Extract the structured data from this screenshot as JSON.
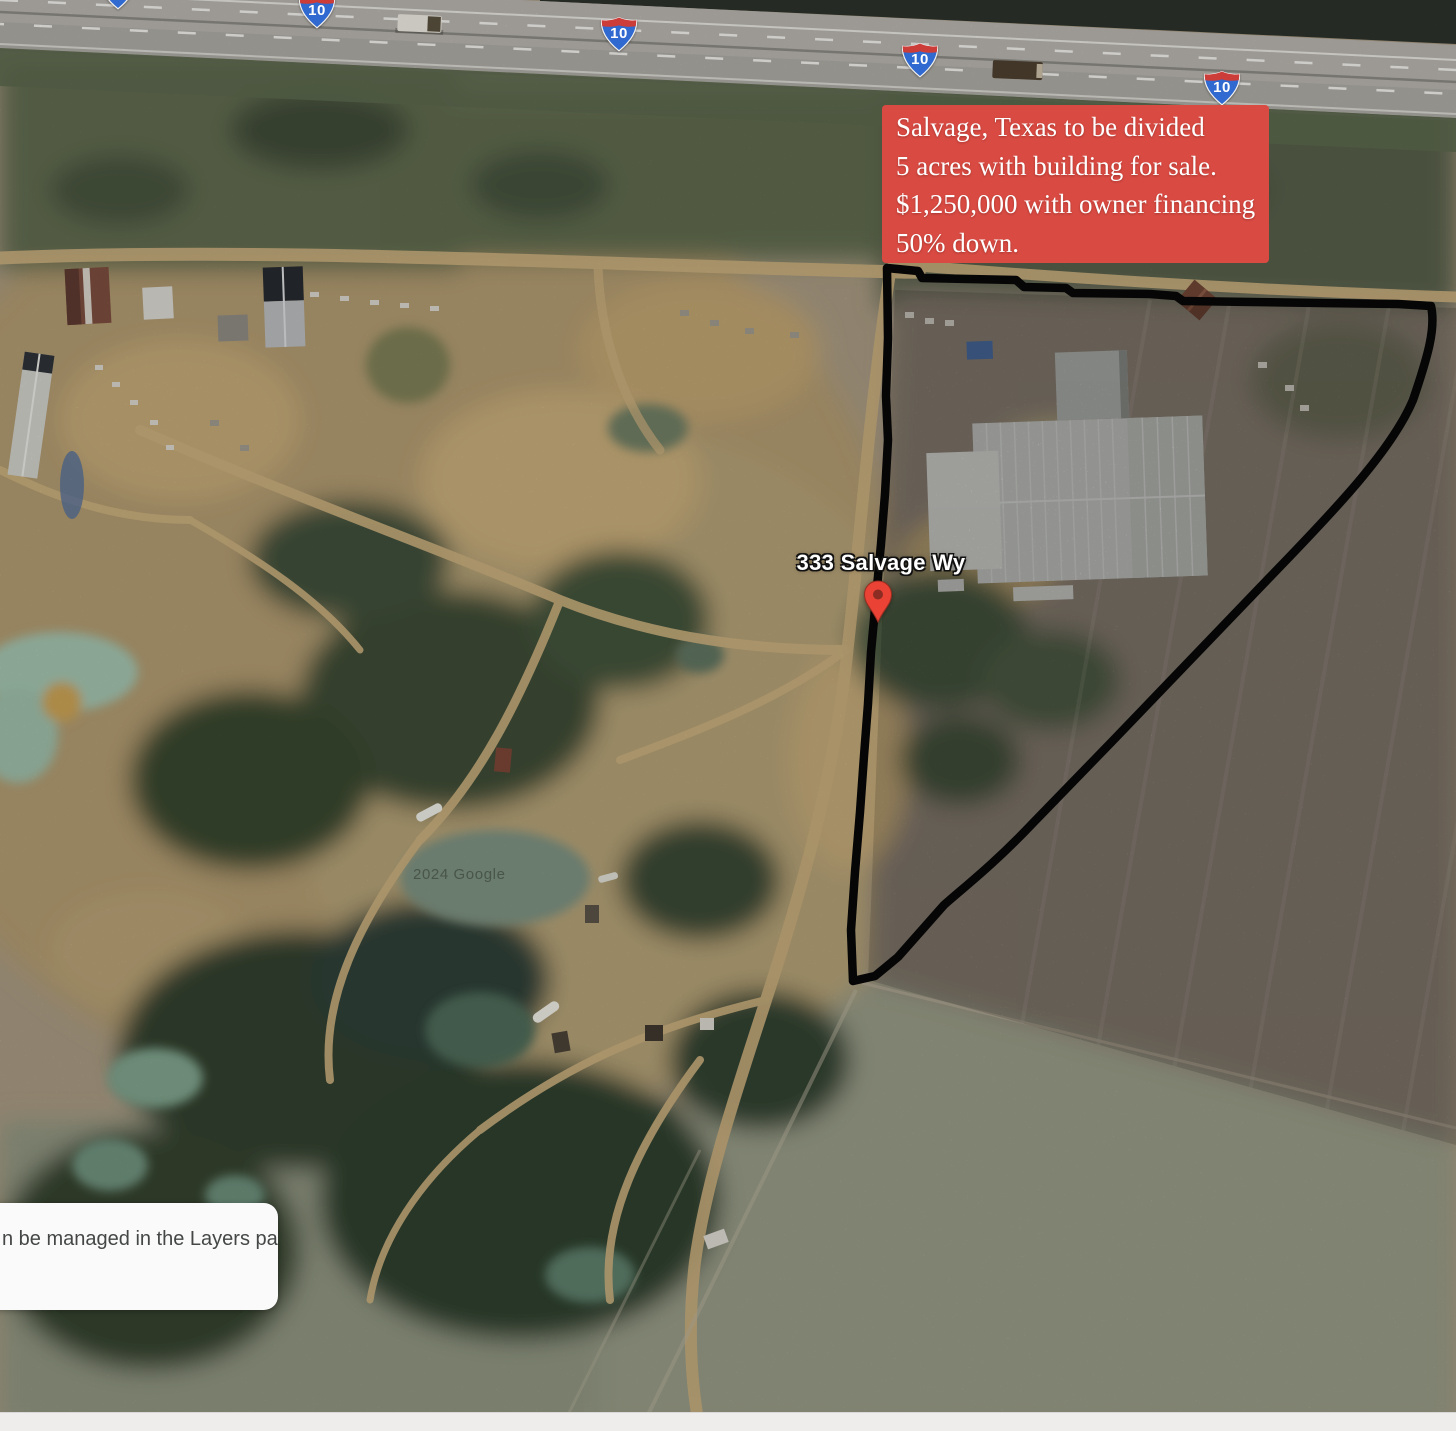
{
  "annotation_box": {
    "lines": [
      "Salvage, Texas to be divided",
      "5 acres with building for sale.",
      "$1,250,000 with owner financing",
      "50% down."
    ]
  },
  "map_overlays": {
    "address_label": "333 Salvage Wy",
    "watermark": "2024 Google",
    "interstate_shield_number": "10"
  },
  "toast": {
    "text": "n be managed in the Layers panel"
  },
  "colors": {
    "annotation_bg": "#d94a42",
    "annotation_text": "#ffffff",
    "boundary": "#060606",
    "pin": "#ea4335",
    "pin_dot": "#8c2c22",
    "shield_blue": "#3069cf",
    "shield_red": "#cc3d3a",
    "toast_bg": "#fafafa"
  }
}
